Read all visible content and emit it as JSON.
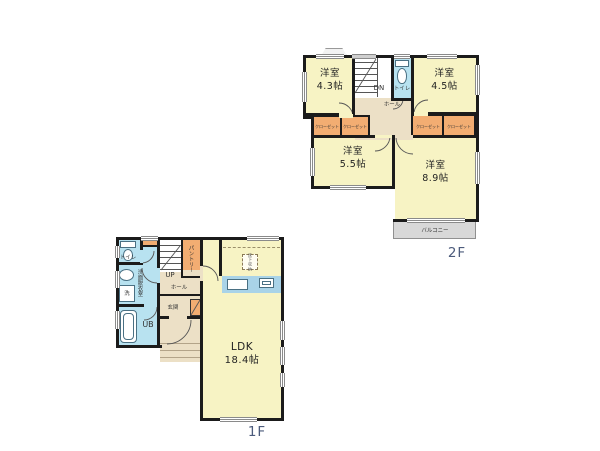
{
  "plan": {
    "floor1": {
      "label": "1F",
      "rooms": {
        "ldk_name": "LDK",
        "ldk_size": "18.4帖",
        "toilet": "トイレ",
        "washroom": "洗面脱衣室",
        "washer": "洗",
        "bath": "UB",
        "stairs": "UP",
        "hall": "ホール",
        "pantry": "パントリー",
        "entrance": "玄関",
        "underfloor_storage": "床下収納"
      }
    },
    "floor2": {
      "label": "2F",
      "rooms": {
        "bedroom43_name": "洋室",
        "bedroom43_size": "4.3帖",
        "bedroom45_name": "洋室",
        "bedroom45_size": "4.5帖",
        "bedroom55_name": "洋室",
        "bedroom55_size": "5.5帖",
        "bedroom89_name": "洋室",
        "bedroom89_size": "8.9帖",
        "stairs": "DN",
        "toilet": "トイレ",
        "hall": "ホール",
        "closet": "クローゼット",
        "balcony": "バルコニー"
      }
    },
    "colors": {
      "room": "#f7f3c4",
      "wet": "#b8e2f0",
      "orange": "#f2ad72",
      "beige": "#ece0c6",
      "gray": "#d8d8d8",
      "kitchen": "#a9d3e8",
      "wall": "#1b1b1b",
      "floorlabel": "#4c5b7c"
    }
  }
}
